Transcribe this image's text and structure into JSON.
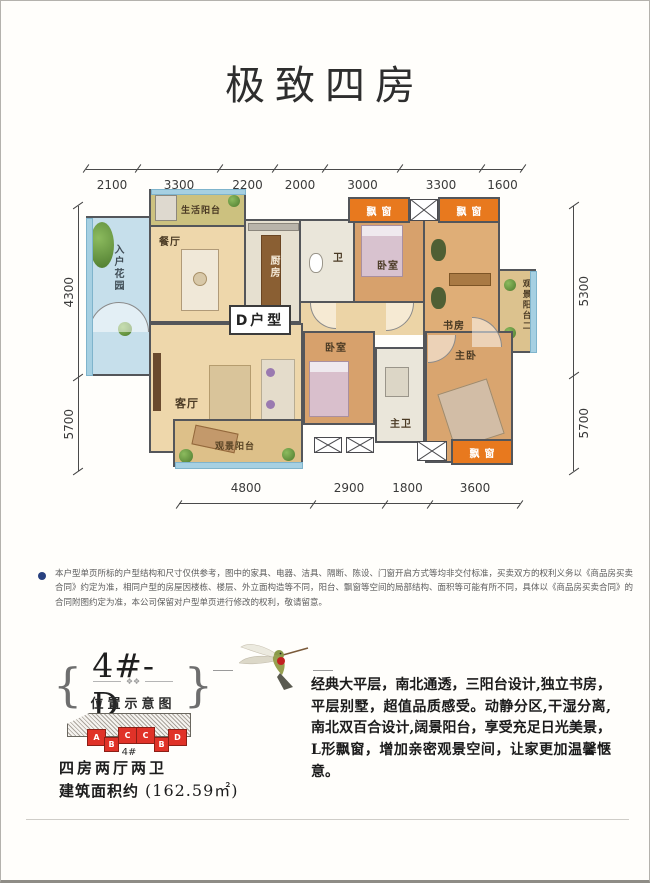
{
  "title": "极致四房",
  "disclaimer": "本户型单页所标的户型结构和尺寸仅供参考，图中的家具、电器、洁具、隔断、陈设、门窗开启方式等均非交付标准，买卖双方的权利义务以《商品房买卖合同》约定为准，相同户型的房屋因楼栋、楼层、外立面构造等不同，阳台、飘窗等空间的局部结构、面积等可能有所不同，具体以《商品房买卖合同》的合同附图约定为准，本公司保留对户型单页进行修改的权利，敬请留意。",
  "plan": {
    "unit_box": "D户型",
    "dims": {
      "top": [
        "2100",
        "3300",
        "2200",
        "2000",
        "3000",
        "3300",
        "1600"
      ],
      "left": [
        "4300",
        "5700"
      ],
      "right": [
        "5300",
        "5700"
      ],
      "bottom": [
        "4800",
        "2900",
        "1800",
        "3600"
      ]
    },
    "rooms": {
      "service_balcony": "生活阳台",
      "entry_garden": "入户花园",
      "dining": "餐厅",
      "kitchen": "厨房",
      "bath": "卫",
      "bedroom_north": "卧室",
      "study": "书房",
      "view_balcony_2": "观景阳台二",
      "living": "客厅",
      "bedroom_south": "卧室",
      "master_bath": "主卫",
      "master_bedroom": "主卧",
      "view_balcony": "观景阳台",
      "bay_window": "飘窗"
    }
  },
  "footer": {
    "brace_left": "{",
    "brace_right": "}",
    "unit_code": "4#-D",
    "ornament": "❖❖",
    "location_title": "位置示意图",
    "blocks": [
      "A",
      "B",
      "C",
      "C",
      "B",
      "D"
    ],
    "building_no": "4#",
    "spec": "四房两厅两卫",
    "area_label": "建筑面积约",
    "area_value": "(162.59㎡)",
    "description": "经典大平层，南北通透，三阳台设计,独立书房，平层别墅，超值品质感受。动静分区,干湿分离,南北双百合设计,阔景阳台，享受充足日光美景，L形飘窗，增加亲密观景空间，让家更加温馨惬意。"
  },
  "colors": {
    "bay_orange": "#e8791e",
    "wall_gray": "#54565a",
    "block_red": "#e03228",
    "bullet_blue": "#28417f",
    "glazing_blue": "#a6d0e2"
  }
}
